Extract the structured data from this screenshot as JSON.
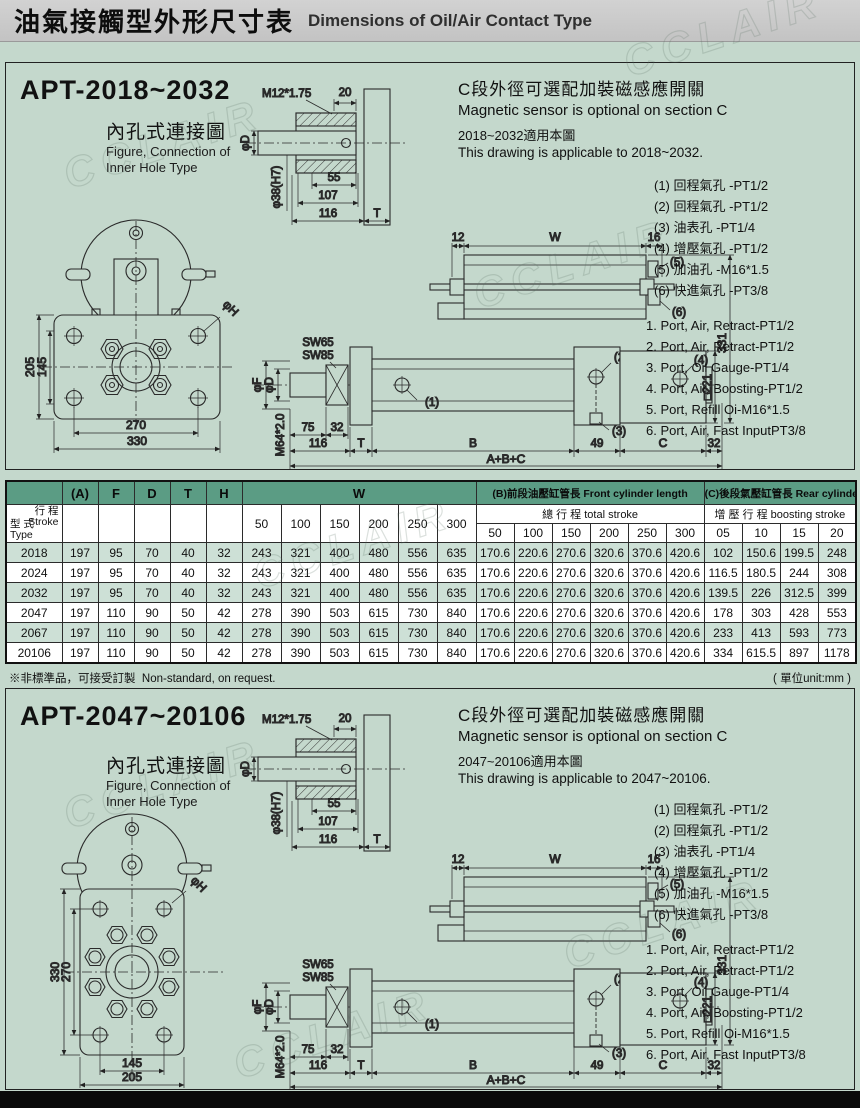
{
  "page": {
    "title_cn": "油氣接觸型外形尺寸表",
    "title_en": "Dimensions of Oil/Air Contact Type",
    "watermark": "CCLAIR",
    "note_cn": "※非標準品，可接受訂製",
    "note_en": "Non-standard, on request.",
    "unit_note": "( 單位unit:mm )"
  },
  "dims": {
    "m12": "M12*1.75",
    "d20": "20",
    "phi_d": "φD",
    "phi38": "φ38(H7)",
    "d55": "55",
    "d107": "107",
    "d116": "116",
    "t": "T",
    "sw65": "SW65",
    "sw85": "SW85",
    "m64": "M64*2.0",
    "phi_f": "φF",
    "d75": "75",
    "d32": "32",
    "b": "B",
    "d49": "49",
    "c": "C",
    "abc": "A+B+C",
    "d12": "12",
    "w": "W",
    "d16": "16",
    "sq221": "□221",
    "d331": "331",
    "phi_h": "φH",
    "c1": "(1)",
    "c2": "(2)",
    "c3": "(3)",
    "c4": "(4)",
    "c5": "(5)",
    "c6": "(6)"
  },
  "sections": [
    {
      "model": "APT-2018~2032",
      "figure_cn": "內孔式連接圖",
      "figure_en1": "Figure, Connection of",
      "figure_en2": "Inner Hole Type",
      "sensor_cn": "C段外徑可選配加裝磁感應開關",
      "sensor_en": "Magnetic sensor is optional on section C",
      "applicable_cn": "2018~2032適用本圖",
      "applicable_en": "This drawing is applicable to 2018~2032.",
      "flange": {
        "v_outer": "205",
        "v_inner": "145",
        "h_inner": "270",
        "h_outer": "330"
      },
      "ports_cn": [
        "(1) 回程氣孔  -PT1/2",
        "(2) 回程氣孔  -PT1/2",
        "(3) 油表孔  -PT1/4",
        "(4) 增壓氣孔  -PT1/2",
        "(5) 加油孔  -M16*1.5",
        "(6) 快進氣孔  -PT3/8"
      ],
      "ports_en": [
        "1. Port, Air, Retract-PT1/2",
        "2. Port, Air, Retract-PT1/2",
        "3. Port, Oil Gauge-PT1/4",
        "4. Port, Air, Boosting-PT1/2",
        "5. Port, Refill Oi-M16*1.5",
        "6. Port, Air, Fast InputPT3/8"
      ]
    },
    {
      "model": "APT-2047~20106",
      "figure_cn": "內孔式連接圖",
      "figure_en1": "Figure, Connection of",
      "figure_en2": "Inner Hole Type",
      "sensor_cn": "C段外徑可選配加裝磁感應開關",
      "sensor_en": "Magnetic sensor is optional on section C",
      "applicable_cn": "2047~20106適用本圖",
      "applicable_en": "This drawing is applicable to 2047~20106.",
      "flange": {
        "v_outer": "330",
        "v_inner": "270",
        "h_inner": "145",
        "h_outer": "205"
      },
      "ports_cn": [
        "(1) 回程氣孔  -PT1/2",
        "(2) 回程氣孔  -PT1/2",
        "(3) 油表孔  -PT1/4",
        "(4) 增壓氣孔  -PT1/2",
        "(5) 加油孔  -M16*1.5",
        "(6) 快進氣孔  -PT3/8"
      ],
      "ports_en": [
        "1. Port, Air, Retract-PT1/2",
        "2. Port, Air, Retract-PT1/2",
        "3. Port, Oil Gauge-PT1/4",
        "4. Port, Air, Boosting-PT1/2",
        "5. Port, Refill Oi-M16*1.5",
        "6. Port, Air, Fast InputPT3/8"
      ]
    }
  ],
  "table": {
    "corner": {
      "stroke_cn": "行 程",
      "stroke_en": "Stroke",
      "type_cn": "型 式",
      "type_en": "Type"
    },
    "cols_basic": [
      "(A)",
      "F",
      "D",
      "T",
      "H"
    ],
    "w_label": "W",
    "w_cols": [
      "50",
      "100",
      "150",
      "200",
      "250",
      "300"
    ],
    "group_b_cn": "(B)前段油壓缸管長",
    "group_b_en": "Front cylinder length",
    "sub_b_cn": "總 行 程",
    "sub_b_en": "total stroke",
    "b_cols": [
      "50",
      "100",
      "150",
      "200",
      "250",
      "300"
    ],
    "group_c_cn": "(C)後段氣壓缸管長",
    "group_c_en": "Rear cylinder length",
    "sub_c_cn": "增 壓 行 程",
    "sub_c_en": "boosting stroke",
    "c_cols": [
      "05",
      "10",
      "15",
      "20"
    ],
    "rows": [
      {
        "type": "2018",
        "a": "197",
        "f": "95",
        "d": "70",
        "t": "40",
        "h": "32",
        "w": [
          "243",
          "321",
          "400",
          "480",
          "556",
          "635"
        ],
        "b": [
          "170.6",
          "220.6",
          "270.6",
          "320.6",
          "370.6",
          "420.6"
        ],
        "c": [
          "102",
          "150.6",
          "199.5",
          "248"
        ]
      },
      {
        "type": "2024",
        "a": "197",
        "f": "95",
        "d": "70",
        "t": "40",
        "h": "32",
        "w": [
          "243",
          "321",
          "400",
          "480",
          "556",
          "635"
        ],
        "b": [
          "170.6",
          "220.6",
          "270.6",
          "320.6",
          "370.6",
          "420.6"
        ],
        "c": [
          "116.5",
          "180.5",
          "244",
          "308"
        ]
      },
      {
        "type": "2032",
        "a": "197",
        "f": "95",
        "d": "70",
        "t": "40",
        "h": "32",
        "w": [
          "243",
          "321",
          "400",
          "480",
          "556",
          "635"
        ],
        "b": [
          "170.6",
          "220.6",
          "270.6",
          "320.6",
          "370.6",
          "420.6"
        ],
        "c": [
          "139.5",
          "226",
          "312.5",
          "399"
        ]
      },
      {
        "type": "2047",
        "a": "197",
        "f": "110",
        "d": "90",
        "t": "50",
        "h": "42",
        "w": [
          "278",
          "390",
          "503",
          "615",
          "730",
          "840"
        ],
        "b": [
          "170.6",
          "220.6",
          "270.6",
          "320.6",
          "370.6",
          "420.6"
        ],
        "c": [
          "178",
          "303",
          "428",
          "553"
        ]
      },
      {
        "type": "2067",
        "a": "197",
        "f": "110",
        "d": "90",
        "t": "50",
        "h": "42",
        "w": [
          "278",
          "390",
          "503",
          "615",
          "730",
          "840"
        ],
        "b": [
          "170.6",
          "220.6",
          "270.6",
          "320.6",
          "370.6",
          "420.6"
        ],
        "c": [
          "233",
          "413",
          "593",
          "773"
        ]
      },
      {
        "type": "20106",
        "a": "197",
        "f": "110",
        "d": "90",
        "t": "50",
        "h": "42",
        "w": [
          "278",
          "390",
          "503",
          "615",
          "730",
          "840"
        ],
        "b": [
          "170.6",
          "220.6",
          "270.6",
          "320.6",
          "370.6",
          "420.6"
        ],
        "c": [
          "334",
          "615.5",
          "897",
          "1178"
        ]
      }
    ]
  }
}
